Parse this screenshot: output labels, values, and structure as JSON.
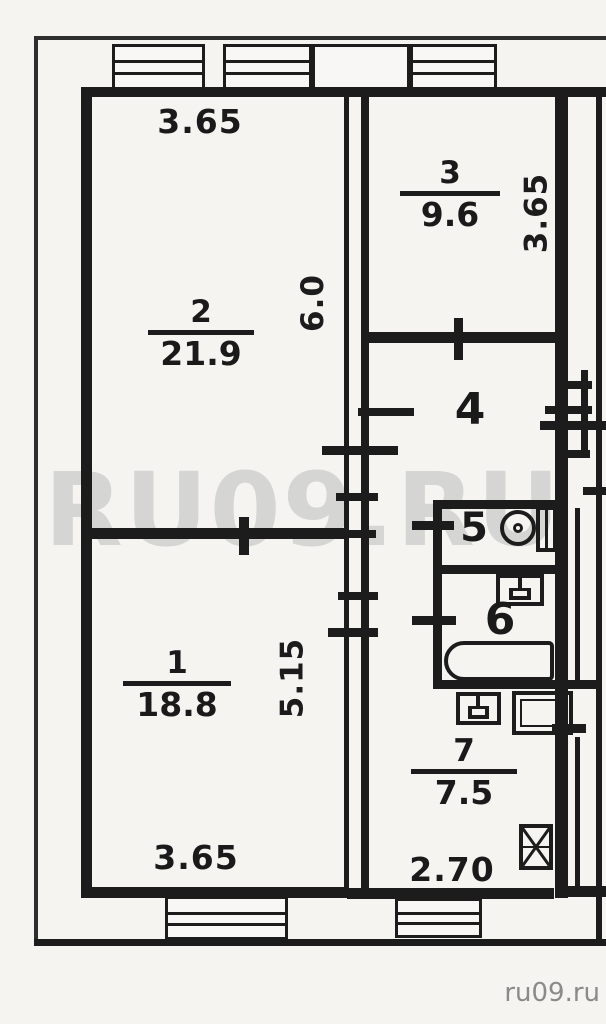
{
  "plan": {
    "watermark": "RU09.RU",
    "footer_link": "ru09.ru",
    "rooms": [
      {
        "number": "1",
        "area": "18.8"
      },
      {
        "number": "2",
        "area": "21.9"
      },
      {
        "number": "3",
        "area": "9.6"
      },
      {
        "number": "4"
      },
      {
        "number": "5"
      },
      {
        "number": "6"
      },
      {
        "number": "7",
        "area": "7.5"
      }
    ],
    "dimensions": {
      "top_width": "3.65",
      "room3_height": "3.65",
      "room2_height": "6.0",
      "room1_height": "5.15",
      "room1_bottom_width": "3.65",
      "kitchen_bottom_width": "2.70"
    },
    "icons": [
      "toilet-icon",
      "washbasin-icon",
      "bathtub-icon",
      "kitchen-sink-icon",
      "stove-icon",
      "vent-shaft-icon",
      "window-symbol",
      "door-opening-tick"
    ],
    "colors": {
      "ink": "#1c1c1c",
      "paper": "#f5f4f1",
      "watermark": "#8f8f8f",
      "footer_text": "#8a8a8a"
    }
  }
}
